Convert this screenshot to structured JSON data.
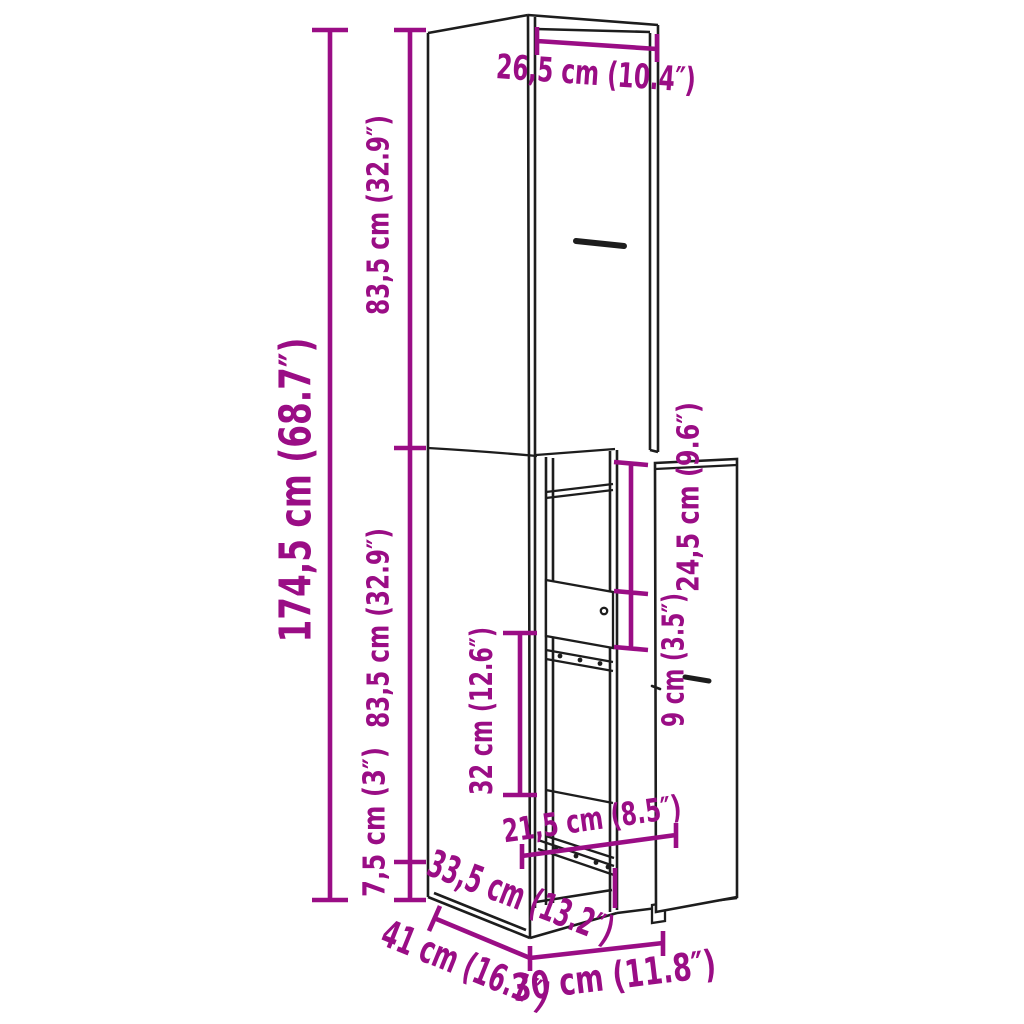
{
  "diagram": {
    "background_color": "#ffffff",
    "line_color": "#1d1d1d",
    "accent_color": "#9a0d85",
    "labels": {
      "total_height": "174,5 cm (68.7″)",
      "upper_section_height": "83,5 cm (32.9″)",
      "lower_section_height": "83,5 cm (32.9″)",
      "plinth_height": "7,5 cm (3″)",
      "top_width": "26,5 cm (10.4″)",
      "upper_opening_height": "24,5 cm (9.6″)",
      "drawer_front_height": "9 cm (3.5″)",
      "lower_opening_height": "32 cm (12.6″)",
      "inner_width": "21,5 cm (8.5″)",
      "depth": "33,5 cm (13.2″)",
      "total_depth": "41 cm (16.1″)",
      "front_width": "30 cm (11.8″)"
    }
  }
}
